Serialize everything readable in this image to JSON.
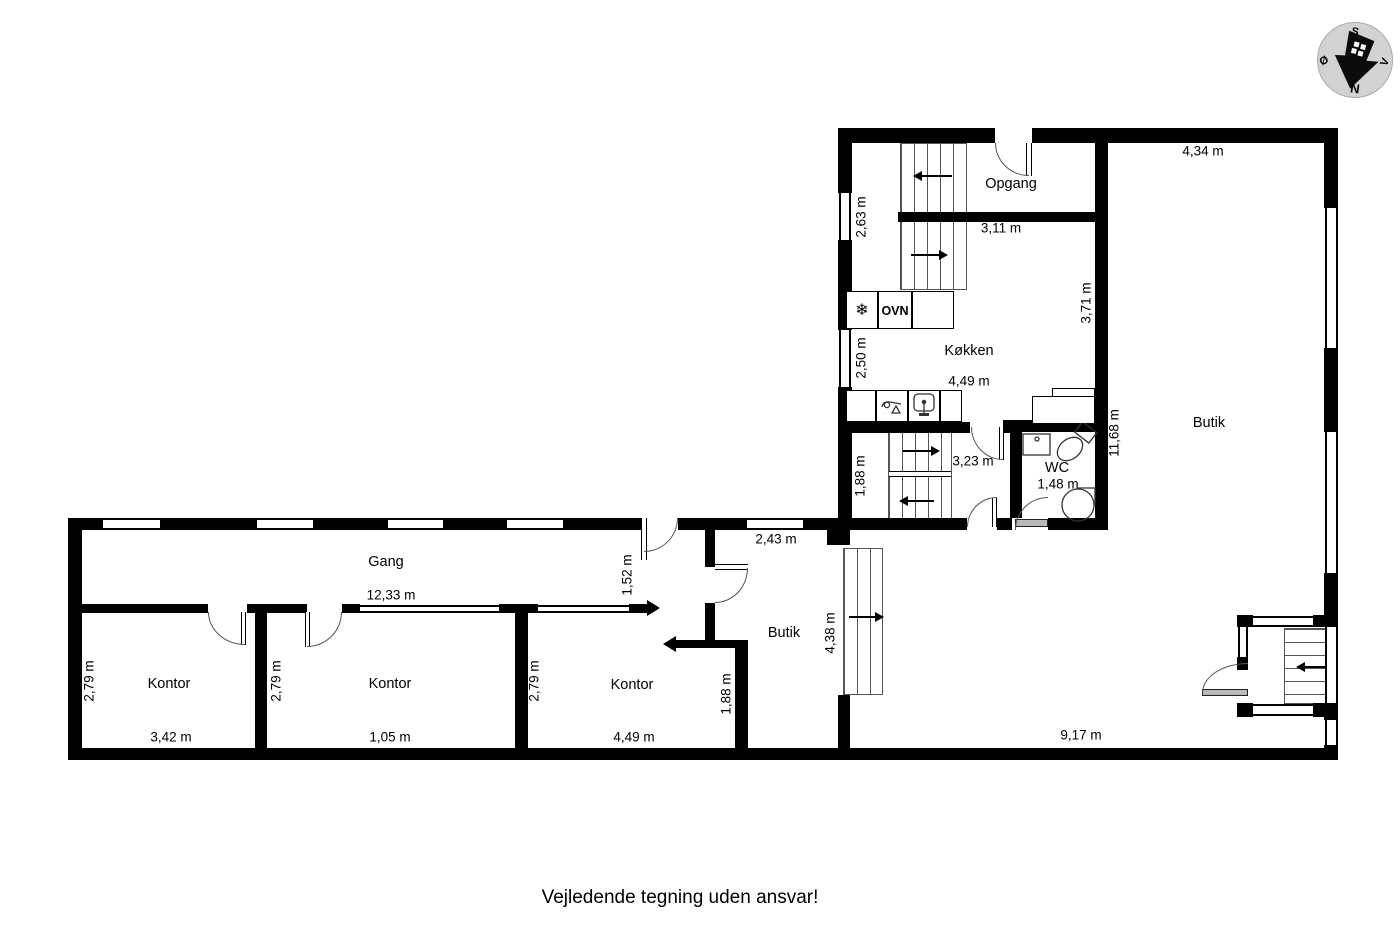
{
  "compass": {
    "south": "S",
    "west": "V",
    "north": "N",
    "east": "Ø"
  },
  "rooms": {
    "opgang": "Opgang",
    "kokken": "Køkken",
    "wc": "WC",
    "butik_right": "Butik",
    "butik_mid": "Butik",
    "gang": "Gang",
    "kontor1": "Kontor",
    "kontor2": "Kontor",
    "kontor3": "Kontor"
  },
  "appliances": {
    "oven_label": "OVN"
  },
  "icons": {
    "freezer": "❄"
  },
  "dims": {
    "opgang_window": "2,63 m",
    "opgang_width": "3,11 m",
    "butik_top_width": "4,34 m",
    "kokken_depth": "3,71 m",
    "kokken_window": "2,50 m",
    "kokken_width": "4,49 m",
    "butik_height": "11,68 m",
    "stairs_height": "1,88 m",
    "stairs_width": "3,23 m",
    "wc_width": "1,48 m",
    "butik_mid_window": "2,43 m",
    "entry_door": "1,52 m",
    "gang_length": "12,33 m",
    "butik_mid_stairs": "4,38 m",
    "kontor3_side": "1,88 m",
    "kontor1_height": "2,79 m",
    "kontor1_width": "3,42 m",
    "kontor2_height": "2,79 m",
    "kontor2_width": "1,05 m",
    "kontor3_height": "2,79 m",
    "kontor3_width": "4,49 m",
    "butik_bottom_width": "9,17 m"
  },
  "footer": {
    "disclaimer": "Vejledende tegning uden ansvar!"
  }
}
